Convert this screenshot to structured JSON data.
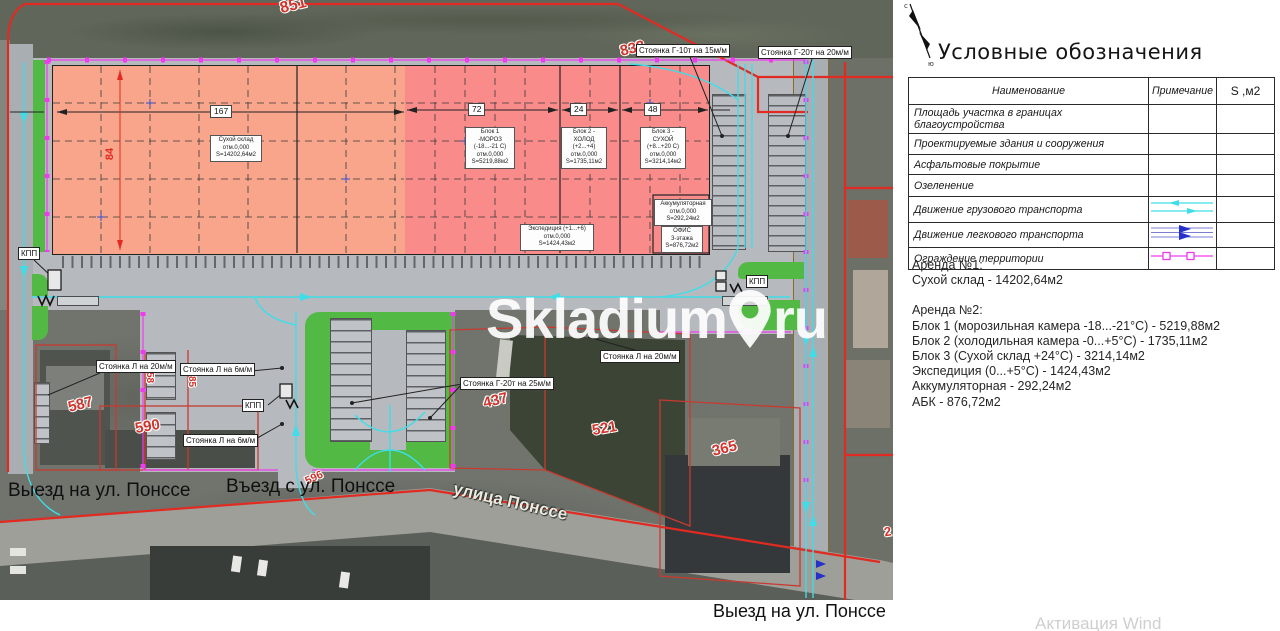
{
  "watermark": {
    "brand": "Skladium",
    "tld": "ru"
  },
  "os_watermark": "Активация Wind",
  "legend": {
    "title": "Условные обозначения",
    "col_name": "Наименование",
    "col_note": "Примечание",
    "col_area": "S ,м2",
    "rows": [
      {
        "name": "Площадь участка в границах благоустройства"
      },
      {
        "name": "Проектируемые здания и сооружения"
      },
      {
        "name": "Асфальтовые покрытие"
      },
      {
        "name": "Озеленение"
      },
      {
        "name": "Движение грузового транспорта"
      },
      {
        "name": "Движение легкового транспорта"
      },
      {
        "name": "Ограждение территории"
      }
    ],
    "colors": {
      "red": "#fa7d78",
      "gray": "#acacac",
      "green": "#55ba47",
      "cyan": "#3fdde8",
      "blue": "#2531c8",
      "magenta": "#ee3bee"
    }
  },
  "rent": {
    "a1_title": "Аренда №1:",
    "a1_l1": "Сухой склад - 14202,64м2",
    "a2_title": "Аренда №2:",
    "a2_l1": "Блок 1 (морозильная камера -18...-21°С) - 5219,88м2",
    "a2_l2": "Блок 2 (холодильная камера -0...+5°С) - 1735,11м2",
    "a2_l3": "Блок 3 (Сухой склад +24°С) - 3214,14м2",
    "a2_l4": "Экспедиция (0...+5°С) - 1424,43м2",
    "a2_l5": "Аккумуляторная - 292,24м2",
    "a2_l6": "АБК - 876,72м2"
  },
  "map": {
    "streets": {
      "exit_left": "Выезд на ул. Понссе",
      "entry": "Въезд с ул. Понссе",
      "street": "улица Понссе",
      "exit_bottom": "Выезд на ул. Понссе"
    },
    "buildings": {
      "dry": "Сухой склад\nотм.0,000\nS=14202,64м2",
      "block1": "Блок 1\n-МОРОЗ\n(-18...-21 С)\nотм.0,000\nS=5219,88м2",
      "block2": "Блок 2 -\nХОЛОД\n(+2...+4)\nотм.0,000\nS=1735,11м2",
      "block3": "Блок 3 -\nСУХОЙ\n(+8...+20 С)\nотм.0,000\nS=3214,14м2",
      "accum": "Аккумуляторная\nотм.0,000\nS=292,24м2",
      "exped": "Экспедиция (+1...+6)\nотм.0,000\nS=1424,43м2",
      "office": "ОФИС\n3-этажа\nS=876,72м2"
    },
    "dims": {
      "d167": "167",
      "d72": "72",
      "d24": "24",
      "d48": "48",
      "d84": "84"
    },
    "parking": {
      "p1": "Стоянка Г-10т на 15м/м",
      "p2": "Стоянка Г-20т на 20м/м",
      "p3": "Стоянка Л на 20м/м",
      "p4": "Стоянка Л на 6м/м",
      "p5": "Стоянка Л на 6м/м",
      "p6": "Стоянка Г-20т на 25м/м",
      "p7": "Стоянка Л на 20м/м"
    },
    "kpp": "КПП",
    "parcels": {
      "n851": "851",
      "n833": "833",
      "n587": "587",
      "n590": "590",
      "n58": "58",
      "n85": "85",
      "n437": "437",
      "n521": "521",
      "n365": "365",
      "n596": "596",
      "n2": "2"
    }
  }
}
